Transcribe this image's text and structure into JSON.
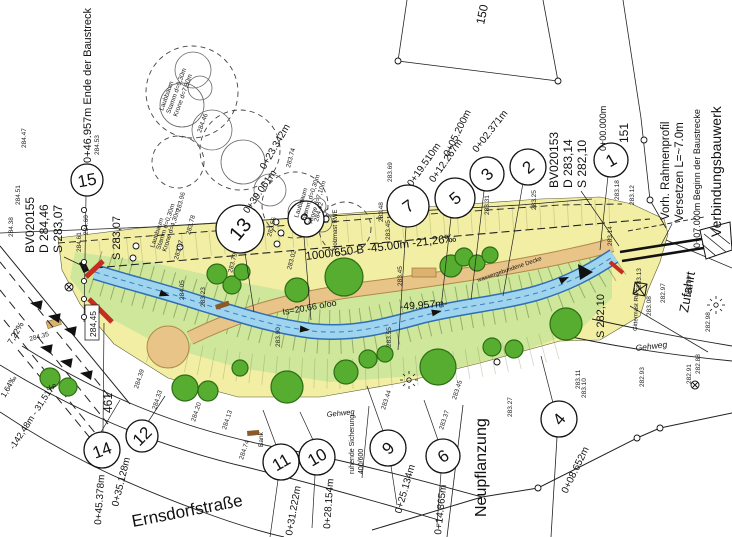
{
  "drawing": {
    "street": "Ernsdorfstraße",
    "area_labels": {
      "neupflanzung": "Neupflanzung",
      "zufahrt": "Zufahrt",
      "gehweg_right": "Gehweg",
      "gehweg_left": "Gehweg",
      "verbindungsbauwerk": "Verbindungsbauwerk",
      "beginn": "0+07.000m Beginn der Baustrecke",
      "ende": "0+46.957m Ende der Baustreck",
      "rahmenprofil_1": "Vorh. Rahmenprofil",
      "rahmenprofil_2": "Versetzen L=~7.0m",
      "ruhende_1": "ruhende Sicherung",
      "ruhende_2": "400/600",
      "decke": "wassergebundene Decke",
      "pipe": "1000/650 B -45.00m -21,26‰",
      "gradient": "Is=20,66 o/oo",
      "laenge": "-49.957m-",
      "road_gradient": "-142,48m - 31,51‰",
      "road_percent": "7,22%",
      "road_promille": "1,64‰",
      "holzmast": "Holzmast RWE",
      "gittermast": "Gittermast RWE",
      "bank": "Bank",
      "parcel_150": "150",
      "parcel_151": "151",
      "parcel_461": "461",
      "box_height": "284,45"
    },
    "benchmarks": {
      "left": {
        "id": "BV020155",
        "d": "D 284,46",
        "s": "S 283,07"
      },
      "left_s": "S 283,07",
      "right": {
        "id": "BV020153",
        "d": "D 283,14",
        "s": "S 282,10"
      },
      "right_s": "S 282,10"
    },
    "tree_labels": {
      "t1": [
        "Laubbaum",
        "Stamm d=0,30m",
        "Krone d=7,80m"
      ],
      "t2": [
        "Laubbaum",
        "Stamm d=0,30m",
        "Krone d=7,10m"
      ],
      "t3": [
        "Laubbaum",
        "Stamm d=0,30m",
        "Krone d=4,30m"
      ]
    },
    "markers": [
      {
        "n": "1",
        "station": "0+00.000m"
      },
      {
        "n": "2",
        "station": "0+02.371m"
      },
      {
        "n": "3",
        "station": "0+05.200m"
      },
      {
        "n": "4",
        "station": "0+08.652m"
      },
      {
        "n": "5",
        "station": "0+12.267m"
      },
      {
        "n": "6",
        "station": "0+14.865m"
      },
      {
        "n": "7",
        "station": "0+19.510m"
      },
      {
        "n": "8",
        "station": "0+23.342m"
      },
      {
        "n": "9",
        "station": "0+25.134m"
      },
      {
        "n": "10",
        "station": "0+28.154m"
      },
      {
        "n": "11",
        "station": "0+31.222m"
      },
      {
        "n": "12",
        "station": "0+35.128m"
      },
      {
        "n": "13",
        "station": "0+39.061m"
      },
      {
        "n": "14",
        "station": "0+45.378m"
      },
      {
        "n": "15",
        "station": "0+46.957m"
      }
    ],
    "elevations": [
      "284.47",
      "284.53",
      "284.51",
      "284.38",
      "284.60",
      "284.61",
      "283.96",
      "283.78",
      "283.97",
      "283.79",
      "283.74",
      "283.56",
      "284.42",
      "283.48",
      "283.45",
      "283.69",
      "283.45",
      "283.31",
      "283.25",
      "283.18",
      "283.12",
      "283.14",
      "283.13",
      "282.97",
      "282.89",
      "283.08",
      "282.98",
      "282.93",
      "282.91",
      "282.88",
      "283.11",
      "284.05",
      "283.23",
      "283.90",
      "283.55",
      "284.35",
      "284.39",
      "284.33",
      "284.20",
      "284.13",
      "284.74",
      "283.27",
      "283.10",
      "283.37",
      "283.45",
      "284.46",
      "283.44",
      "283.02"
    ],
    "colors": {
      "band": "#f2efa0",
      "green": "#cfe79b",
      "stream": "#9fd4ee",
      "stream_edge": "#2f6fb5",
      "path": "#e8c489",
      "tree": "#57ad2f",
      "wall": "#c62c20"
    }
  }
}
